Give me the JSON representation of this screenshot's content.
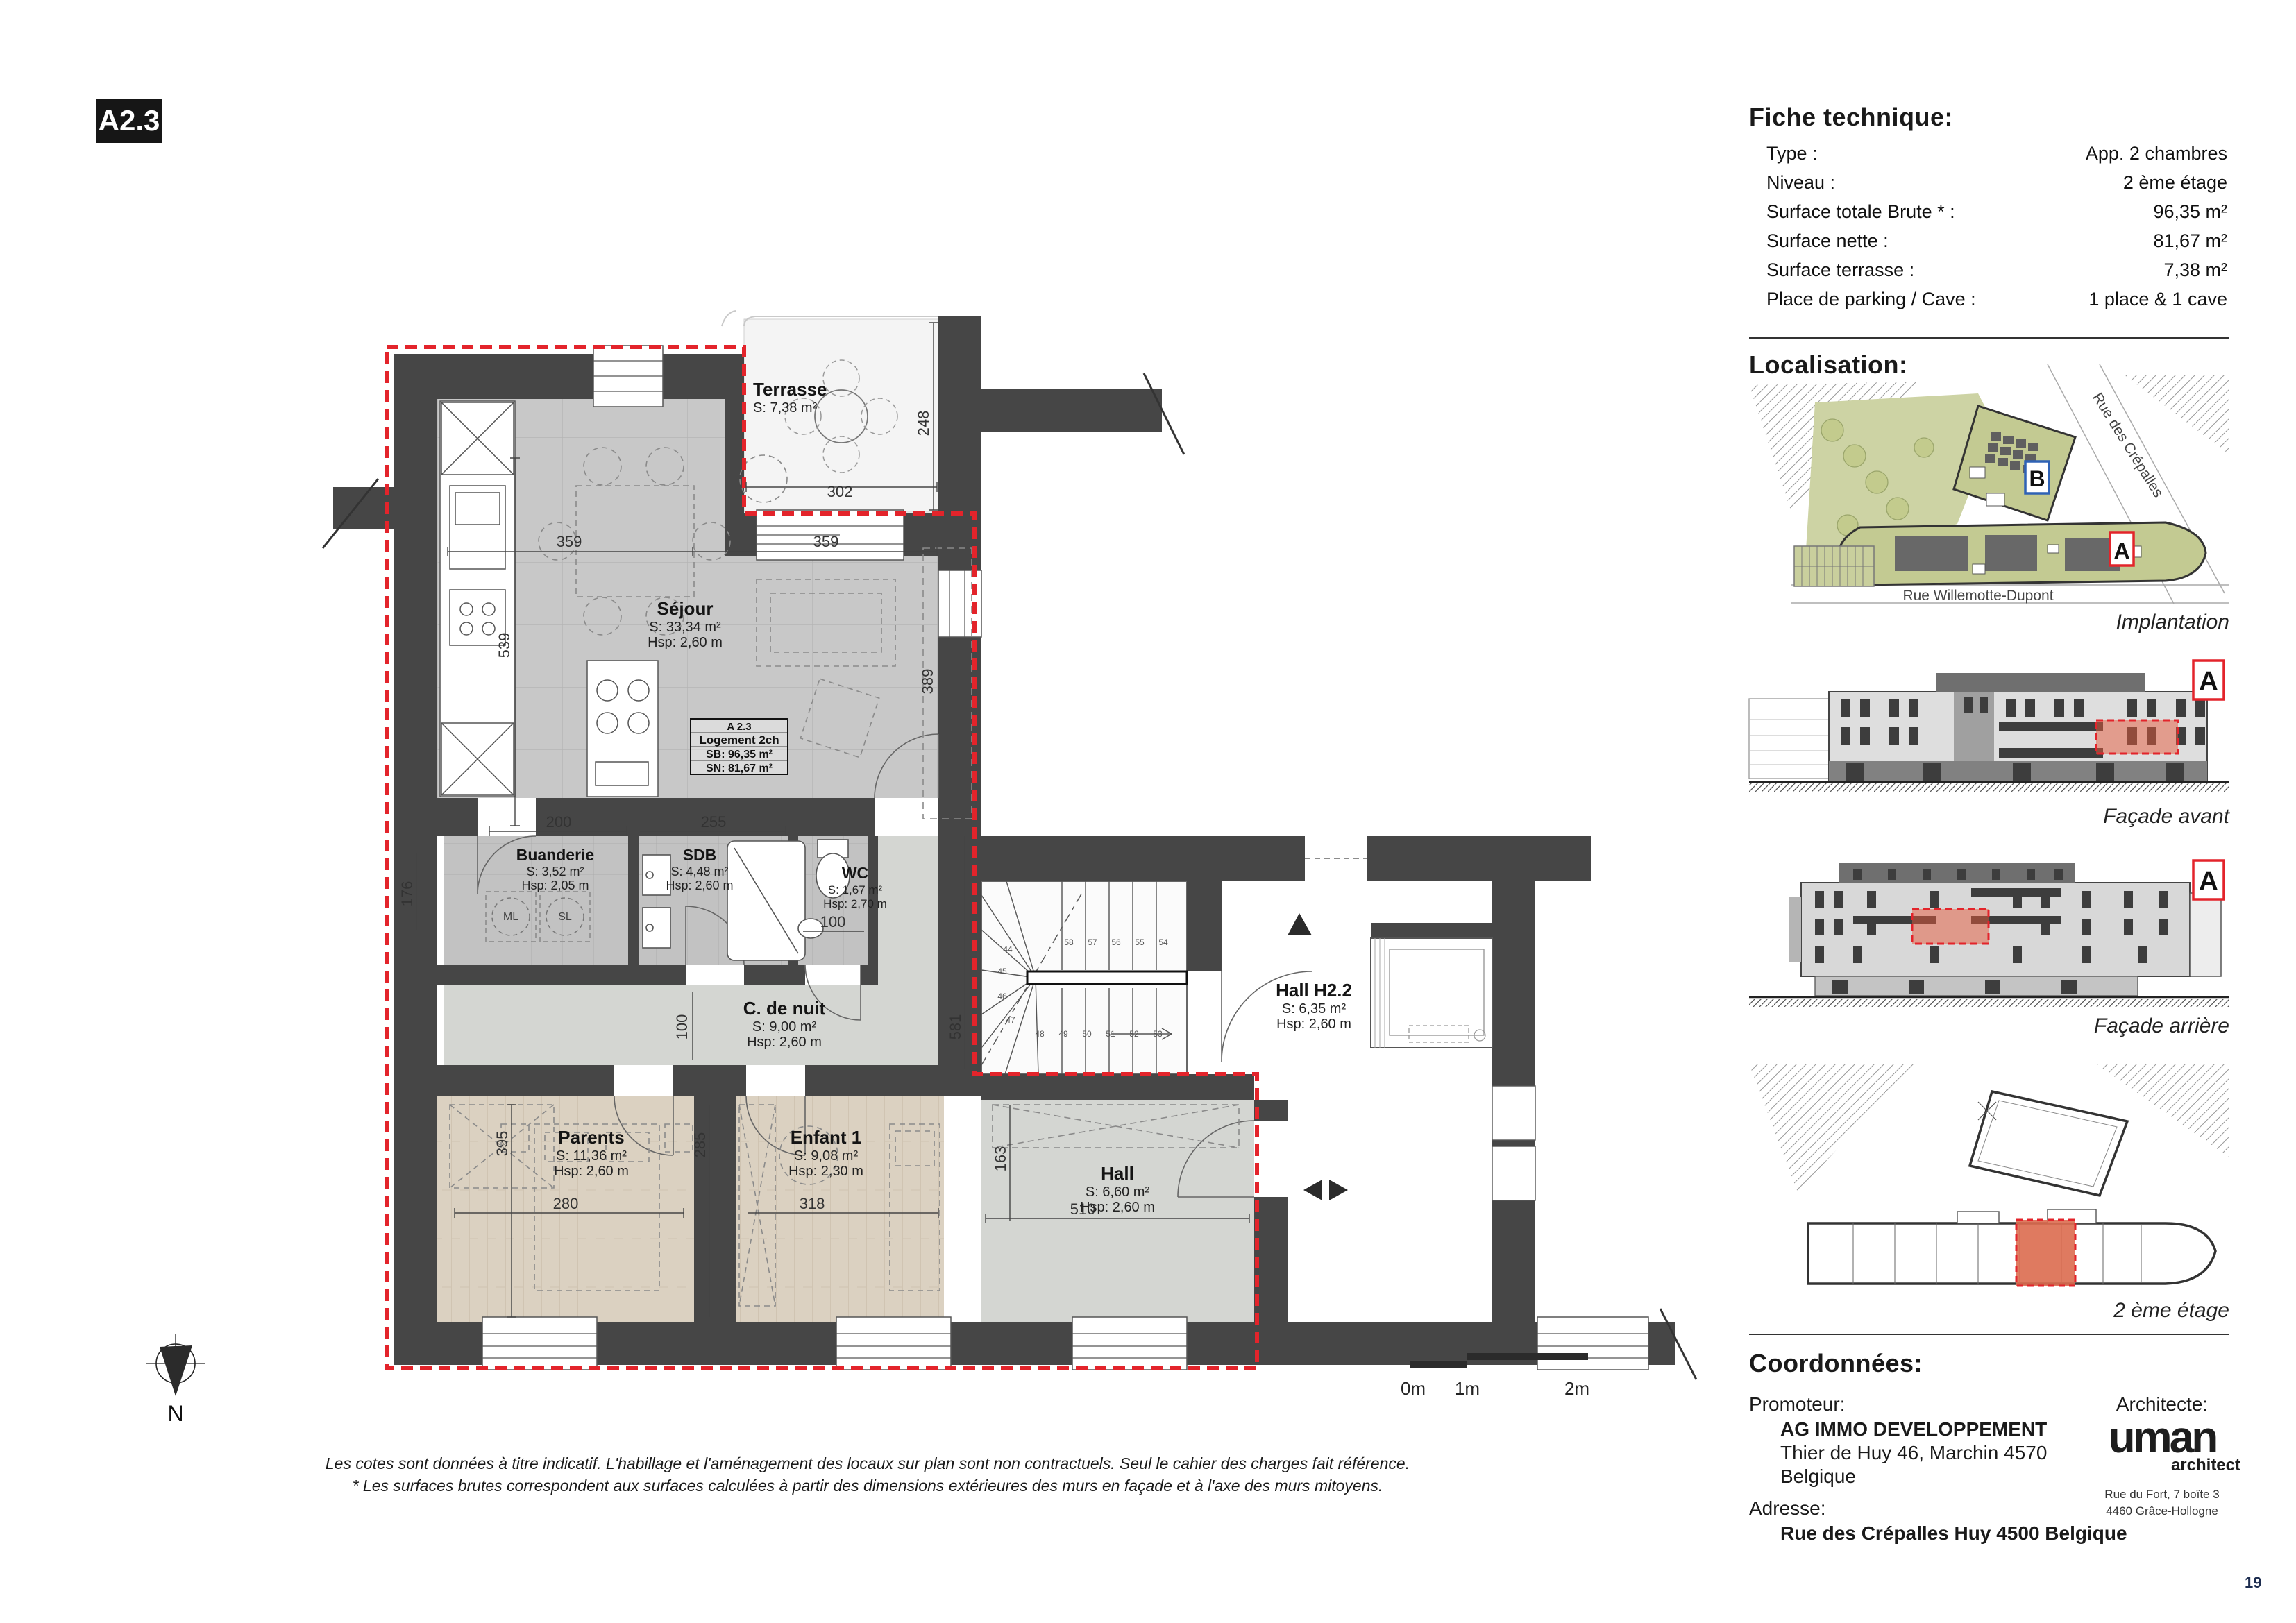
{
  "sheet": {
    "code": "A2.3",
    "page_number": "19"
  },
  "fiche": {
    "title": "Fiche technique:",
    "rows": [
      {
        "label": "Type :",
        "value": "App. 2 chambres"
      },
      {
        "label": "Niveau :",
        "value": "2 ème étage"
      },
      {
        "label": "Surface totale Brute * :",
        "value": "96,35 m²"
      },
      {
        "label": "Surface nette :",
        "value": "81,67 m²"
      },
      {
        "label": "Surface terrasse :",
        "value": "7,38 m²"
      },
      {
        "label": "Place de parking / Cave :",
        "value": "1 place & 1 cave"
      }
    ]
  },
  "localisation": {
    "title": "Localisation:",
    "implantation": {
      "caption": "Implantation",
      "street_diagonal": "Rue des Crépalles",
      "street_bottom": "Rue Willemotte-Dupont",
      "marker_a": "A",
      "marker_b": "B"
    },
    "facade_avant": {
      "caption": "Façade avant",
      "marker": "A"
    },
    "facade_arriere": {
      "caption": "Façade arrière",
      "marker": "A"
    },
    "etage_plan": {
      "caption": "2 ème étage"
    }
  },
  "coordonnees": {
    "title": "Coordonnées:",
    "promoteur_label": "Promoteur:",
    "promoteur_name": "AG IMMO DEVELOPPEMENT",
    "promoteur_addr1": "Thier de Huy 46, Marchin 4570",
    "promoteur_addr2": "Belgique",
    "adresse_label": "Adresse:",
    "adresse": "Rue des Crépalles Huy 4500 Belgique",
    "architecte_label": "Architecte:",
    "logo_text": "uman",
    "logo_sub": "architect",
    "arch_addr1": "Rue du Fort, 7 boîte 3",
    "arch_addr2": "4460 Grâce-Hollogne"
  },
  "plan": {
    "unit_box": {
      "l1": "A 2.3",
      "l2": "Logement 2ch",
      "l3": "SB: 96,35 m²",
      "l4": "SN: 81,67 m²"
    },
    "rooms": {
      "terrasse": {
        "name": "Terrasse",
        "s": "S: 7,38 m²"
      },
      "sejour": {
        "name": "Séjour",
        "s": "S: 33,34 m²",
        "hsp": "Hsp: 2,60 m"
      },
      "buanderie": {
        "name": "Buanderie",
        "s": "S: 3,52 m²",
        "hsp": "Hsp: 2,05 m"
      },
      "sdb": {
        "name": "SDB",
        "s": "S: 4,48 m²",
        "hsp": "Hsp: 2,60 m"
      },
      "wc": {
        "name": "WC",
        "s": "S: 1,67 m²",
        "hsp": "Hsp: 2,70 m"
      },
      "cdenuit": {
        "name": "C. de nuit",
        "s": "S: 9,00 m²",
        "hsp": "Hsp: 2,60 m"
      },
      "parents": {
        "name": "Parents",
        "s": "S: 11,36 m²",
        "hsp": "Hsp: 2,60 m"
      },
      "enfant": {
        "name": "Enfant 1",
        "s": "S: 9,08 m²",
        "hsp": "Hsp: 2,30 m"
      },
      "hall": {
        "name": "Hall",
        "s": "S: 6,60 m²",
        "hsp": "Hsp: 2,60 m"
      },
      "hall_h22": {
        "name": "Hall H2.2",
        "s": "S: 6,35 m²",
        "hsp": "Hsp: 2,60 m"
      }
    },
    "dims": [
      {
        "t": "359"
      },
      {
        "t": "359"
      },
      {
        "t": "539"
      },
      {
        "t": "389"
      },
      {
        "t": "302"
      },
      {
        "t": "248"
      },
      {
        "t": "200"
      },
      {
        "t": "255"
      },
      {
        "t": "176"
      },
      {
        "t": "100"
      },
      {
        "t": "100"
      },
      {
        "t": "581"
      },
      {
        "t": "395"
      },
      {
        "t": "280"
      },
      {
        "t": "285"
      },
      {
        "t": "318"
      },
      {
        "t": "163"
      },
      {
        "t": "510"
      }
    ],
    "stairs": [
      "44",
      "45",
      "46",
      "47",
      "48",
      "49",
      "50",
      "51",
      "52",
      "53",
      "54",
      "55",
      "56",
      "57",
      "58"
    ],
    "appliances": {
      "ml": "ML",
      "sl": "SL"
    }
  },
  "scalebar": {
    "l0": "0m",
    "l1": "1m",
    "l2": "2m"
  },
  "north_label": "N",
  "footnote": {
    "line1": "Les cotes sont données à titre indicatif. L'habillage et l'aménagement des locaux sur plan sont non contractuels. Seul le cahier des charges fait référence.",
    "line2": "* Les surfaces brutes correspondent aux surfaces calculées à partir des dimensions extérieures des murs en façade et à l'axe des murs mitoyens."
  }
}
